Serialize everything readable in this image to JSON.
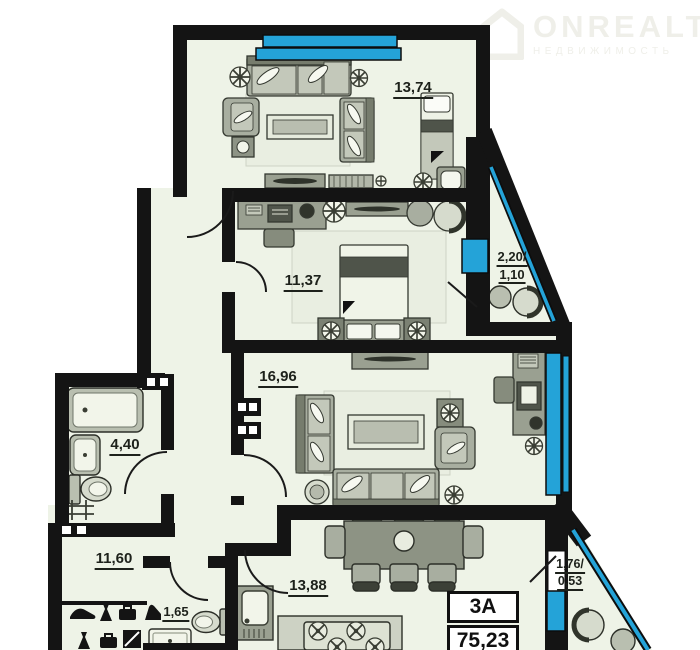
{
  "watermark": {
    "brand": "ONREALT",
    "subtitle": "НЕДВИЖИМОСТЬ"
  },
  "rooms": {
    "living_top": {
      "area": "13,74"
    },
    "balcony_top": {
      "line1": "2,20/",
      "line2": "1,10"
    },
    "bedroom": {
      "area": "11,37"
    },
    "living_main": {
      "area": "16,96"
    },
    "bathroom": {
      "area": "4,40"
    },
    "hallway": {
      "area": "11,60"
    },
    "wc": {
      "area": "1,65"
    },
    "kitchen": {
      "area": "13,88"
    },
    "balcony_bottom": {
      "line1": "1,76/",
      "line2": "0,53"
    }
  },
  "info_box": {
    "unit": "3А",
    "total_area": "75,23"
  },
  "colors": {
    "wall": "#141414",
    "glazing": "#24a3d8",
    "floor": "#eef3e7"
  }
}
